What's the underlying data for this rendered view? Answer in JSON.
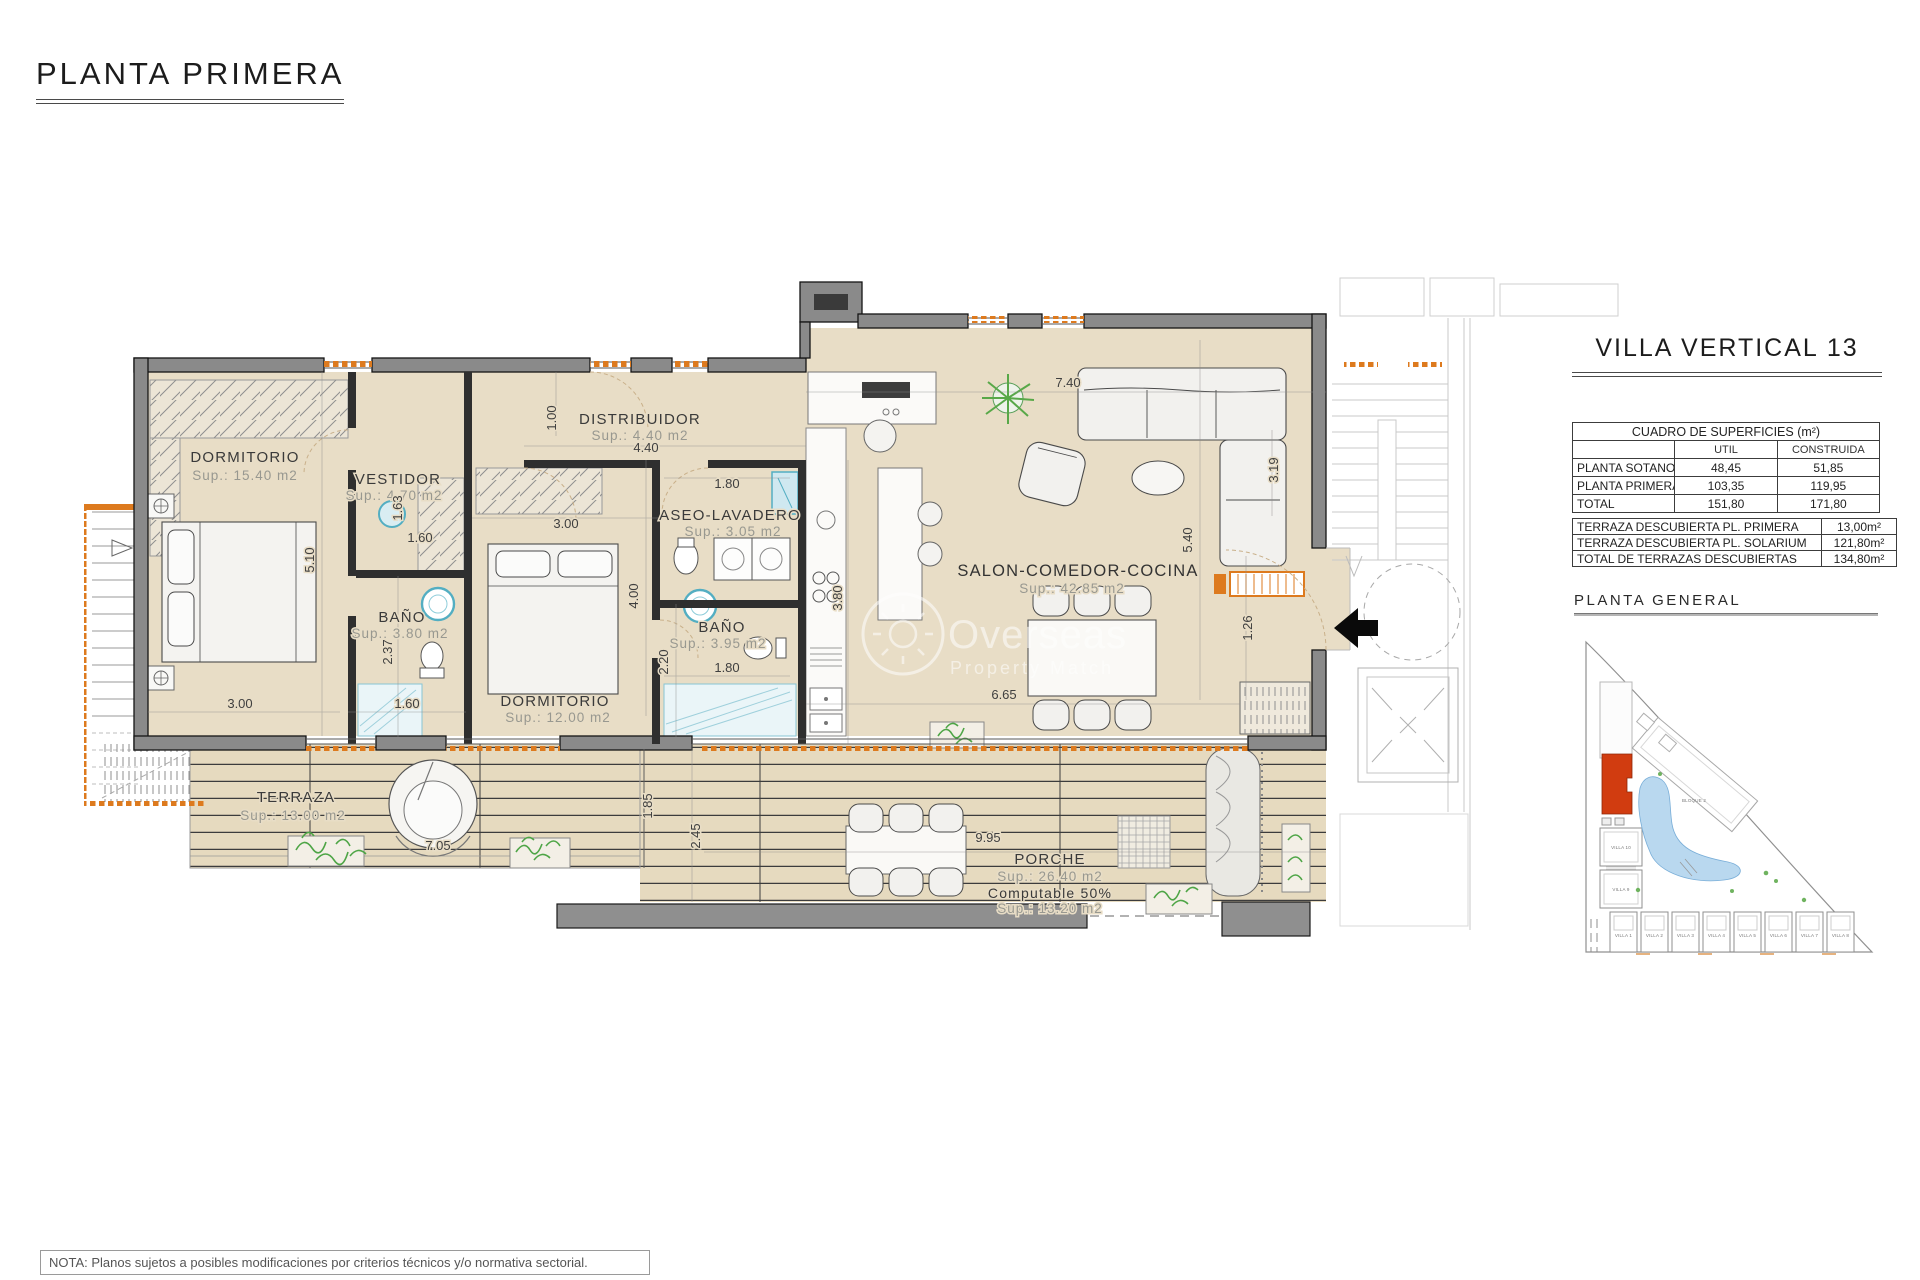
{
  "page": {
    "title": "PLANTA PRIMERA",
    "note": "NOTA: Planos sujetos a posibles modificaciones por criterios técnicos y/o normativa sectorial."
  },
  "watermark": {
    "line1": "Overseas",
    "line2": "Property Match"
  },
  "panel": {
    "title": "VILLA VERTICAL 13",
    "surfaces_table": {
      "title": "CUADRO DE SUPERFICIES (m²)",
      "columns": [
        "UTIL",
        "CONSTRUIDA"
      ],
      "rows": [
        {
          "label": "PLANTA SOTANO",
          "util": "48,45",
          "construida": "51,85"
        },
        {
          "label": "PLANTA PRIMERA",
          "util": "103,35",
          "construida": "119,95"
        },
        {
          "label": "TOTAL",
          "util": "151,80",
          "construida": "171,80"
        }
      ]
    },
    "terraces_table": {
      "rows": [
        {
          "label": "TERRAZA DESCUBIERTA PL. PRIMERA",
          "value": "13,00m²"
        },
        {
          "label": "TERRAZA DESCUBIERTA PL. SOLARIUM",
          "value": "121,80m²"
        },
        {
          "label": "TOTAL DE TERRAZAS DESCUBIERTAS",
          "value": "134,80m²"
        }
      ]
    },
    "site_plan": {
      "title": "PLANTA GENERAL",
      "bloque": "BLOQUE 2",
      "villa10": "VILLA 10",
      "villa9": "VILLA 9",
      "villas_row": [
        "VILLA 1",
        "VILLA 2",
        "VILLA 3",
        "VILLA 4",
        "VILLA 5",
        "VILLA 6",
        "VILLA 7",
        "VILLA 8"
      ]
    }
  },
  "plan": {
    "rooms": [
      {
        "name": "DORMITORIO",
        "sup": "Sup.: 15.40  m2"
      },
      {
        "name": "VESTIDOR",
        "sup": "Sup.: 4.70  m2"
      },
      {
        "name": "BAÑO",
        "sup": "Sup.: 3.80  m2"
      },
      {
        "name": "DISTRIBUIDOR",
        "sup": "Sup.: 4.40  m2"
      },
      {
        "name": "ASEO-LAVADERO",
        "sup": "Sup.: 3.05  m2"
      },
      {
        "name": "BAÑO",
        "sup": "Sup.: 3.95  m2"
      },
      {
        "name": "DORMITORIO",
        "sup": "Sup.: 12.00 m2"
      },
      {
        "name": "SALON-COMEDOR-COCINA",
        "sup": "Sup.: 42.85 m2"
      },
      {
        "name": "TERRAZA",
        "sup": "Sup.: 13.00 m2"
      },
      {
        "name": "PORCHE",
        "sup": "Sup.: 26.40 m2",
        "extra1": "Computable 50%",
        "extra2": "Sup.: 13.20 m2"
      }
    ],
    "dims": [
      "5.10",
      "3.00",
      "1.60",
      "2.37",
      "1.63",
      "1.60",
      "1.00",
      "4.40",
      "3.00",
      "1.80",
      "4.00",
      "2.20",
      "1.80",
      "3.80",
      "7.40",
      "3.19",
      "5.40",
      "1.26",
      "6.65",
      "7.05",
      "1.85",
      "2.45",
      "9.95"
    ]
  },
  "colors": {
    "floor": "#e8ddc6",
    "wall": "#8a8a8a",
    "accent_orange": "#dd7a1e",
    "fixture_cyan": "#53aec2",
    "site_red": "#d13c10",
    "lagoon": "#b9d8ef"
  }
}
